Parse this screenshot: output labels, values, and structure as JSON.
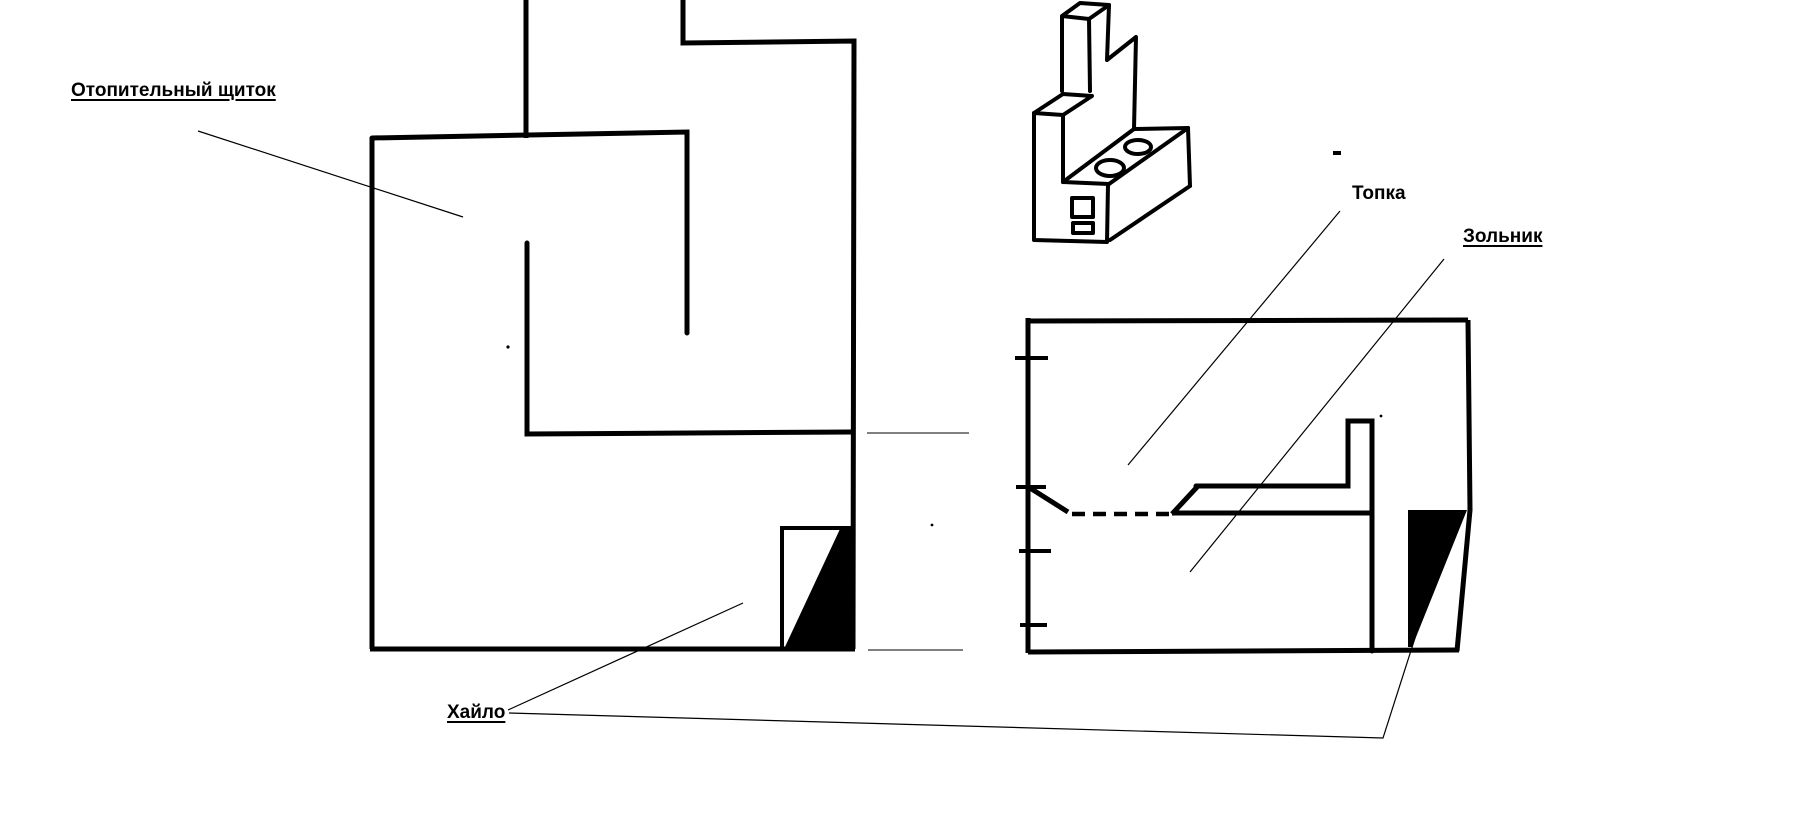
{
  "page": {
    "background_color": "#ffffff",
    "ink_color": "#000000",
    "width": 1795,
    "height": 829
  },
  "labels": {
    "heating_shield": "Отопительный щиток",
    "firebox": "Топка",
    "ash_pit": "Зольник",
    "flue_opening": "Хайло"
  }
}
